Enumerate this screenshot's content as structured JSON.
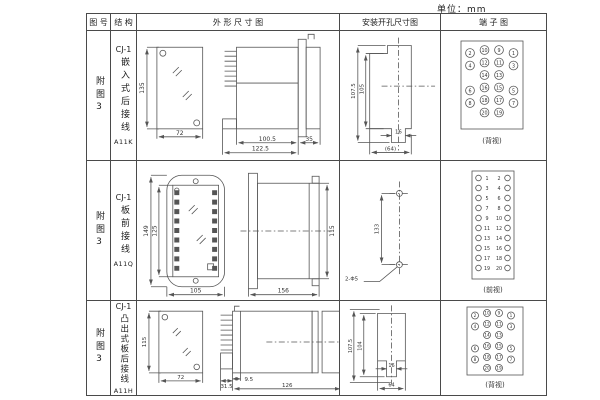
{
  "unit_label": "单位：mm",
  "headers": {
    "fig_no": "图 号",
    "structure": "结 构",
    "outline": "外 形 尺 寸 图",
    "install": "安装开孔尺寸图",
    "terminal": "端 子 图"
  },
  "rows": [
    {
      "fig_no": "附图3",
      "model_prefix": "CJ-1",
      "structure_chars": "嵌入式后接线",
      "model": "A11K",
      "outline": {
        "front_h": "135",
        "front_w": "72",
        "body_l": "100.5",
        "total_l": "122.5",
        "rear_l": "35"
      },
      "install": {
        "outer_h": "107.5",
        "inner_h": "105",
        "slot_w": "16",
        "span_w": "(64)"
      },
      "terminal": {
        "view_label": "(背视)",
        "grid": [
          [
            "2",
            "10",
            "9",
            "1"
          ],
          [
            "4",
            "12",
            "11",
            "3"
          ],
          [
            "",
            "14",
            "13",
            ""
          ],
          [
            "6",
            "16",
            "15",
            "5"
          ],
          [
            "8",
            "18",
            "17",
            "7"
          ],
          [
            "",
            "20",
            "19",
            ""
          ]
        ]
      }
    },
    {
      "fig_no": "附图3",
      "model_prefix": "CJ-1",
      "structure_chars": "板前接线",
      "model": "A11Q",
      "outline": {
        "outer_h": "149",
        "inner_h": "125",
        "front_w": "105",
        "body_l": "156",
        "side_h": "115"
      },
      "install": {
        "hole_dist": "133",
        "hole_label": "2-Φ5"
      },
      "terminal": {
        "view_label": "(前视)",
        "left_nums": [
          "1",
          "3",
          "5",
          "7",
          "9",
          "11",
          "13",
          "15",
          "17",
          "19"
        ],
        "right_nums": [
          "2",
          "4",
          "6",
          "8",
          "10",
          "12",
          "14",
          "16",
          "18",
          "20"
        ]
      }
    },
    {
      "fig_no": "附图3",
      "model_prefix": "CJ-1",
      "structure_chars": "凸出式板后接线",
      "model": "A11H",
      "outline": {
        "front_h": "115",
        "front_w": "72",
        "pin_l": "31.5",
        "step_l": "9.5",
        "body_l": "126"
      },
      "install": {
        "outer_h": "107.5",
        "inner_h": "104",
        "slot_w": "16",
        "span_w": "64"
      },
      "terminal": {
        "view_label": "(背视)",
        "grid": [
          [
            "2",
            "10",
            "9",
            "1"
          ],
          [
            "4",
            "12",
            "11",
            "3"
          ],
          [
            "",
            "14",
            "13",
            ""
          ],
          [
            "6",
            "16",
            "15",
            "5"
          ],
          [
            "8",
            "18",
            "17",
            "7"
          ],
          [
            "",
            "20",
            "19",
            ""
          ]
        ]
      }
    }
  ]
}
